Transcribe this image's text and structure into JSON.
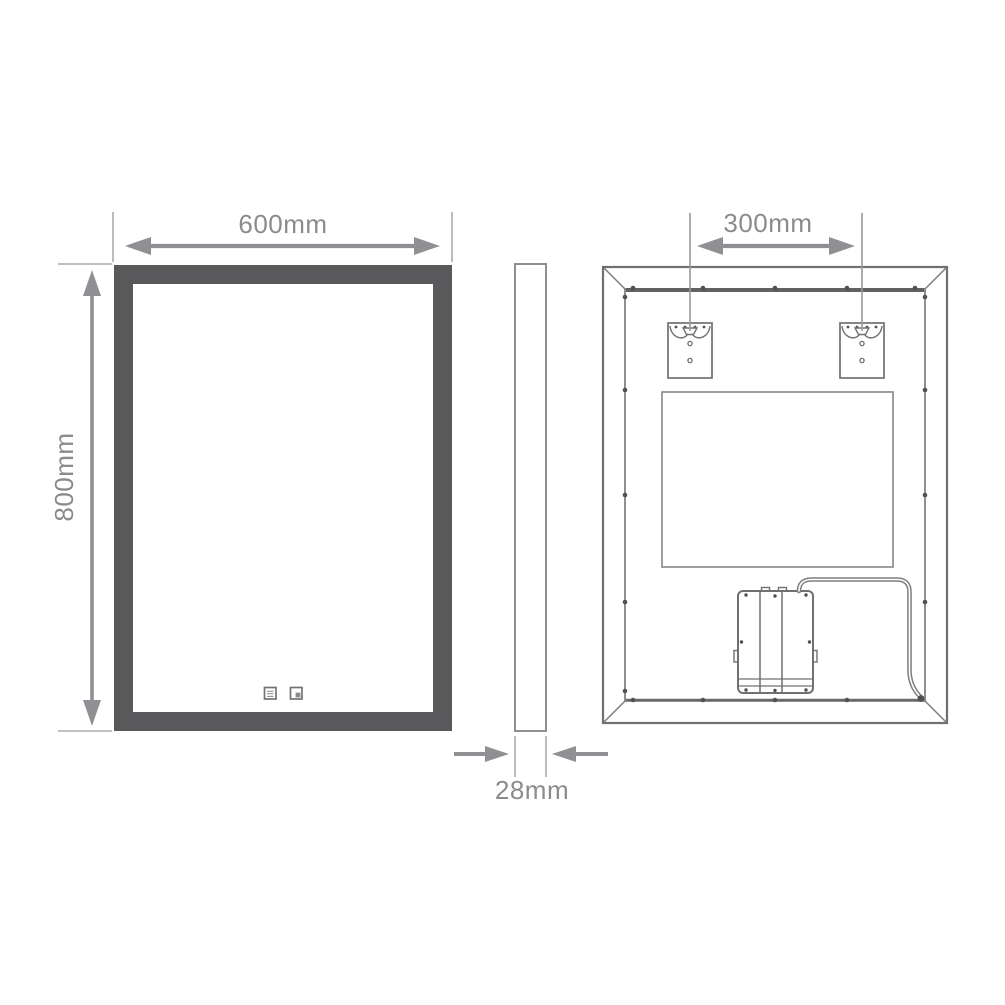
{
  "page": {
    "type": "technical-dimension-drawing",
    "subject": "LED bathroom mirror - front, side and back views",
    "background": "#ffffff"
  },
  "dimensions": {
    "width": "600mm",
    "height": "800mm",
    "thickness": "28mm",
    "bracket_spacing": "300mm"
  },
  "views": {
    "front": {
      "name": "front-view",
      "features": [
        "frame",
        "mirror-glass",
        "touch-controls"
      ]
    },
    "side": {
      "name": "side-profile-view"
    },
    "back": {
      "name": "back-view",
      "features": [
        "beveled-frame",
        "screws",
        "keyhole-brackets",
        "led-panel",
        "driver-box",
        "power-cable"
      ]
    }
  },
  "icons": {
    "touch_control_1": "demister-touch-icon",
    "touch_control_2": "light-touch-icon"
  },
  "colors": {
    "frame": "#59595b",
    "outline": "#6f7073",
    "dimension_line": "#8f9093",
    "extension_line": "#ababad",
    "dimension_text": "#8a8b8d",
    "screw_dot": "#505153"
  }
}
